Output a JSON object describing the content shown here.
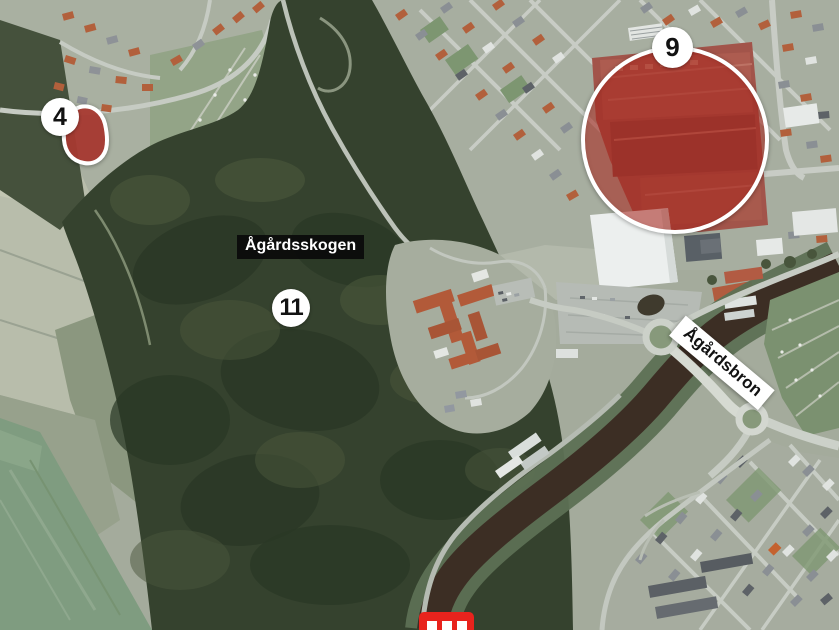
{
  "map": {
    "type": "annotated-aerial-map",
    "region_label": {
      "text": "Ågårdsskogen"
    },
    "bridge_label": {
      "text": "Ågårdsbron"
    },
    "markers": [
      {
        "number": "4",
        "highlight": "small-red-area"
      },
      {
        "number": "9",
        "highlight": "large-red-circle"
      },
      {
        "number": "11",
        "highlight": "none"
      }
    ],
    "logo": {
      "name": "publisher-logo-partial",
      "bars": 3
    },
    "colors": {
      "highlight_red": "#aa3a31",
      "circle_highlight_fill": "rgba(197,41,32,0.48)",
      "highlight_outline": "#ffffff",
      "marker_badge_bg": "#ffffff",
      "marker_badge_text": "#121212",
      "region_label_bg": "#0a0a0a",
      "region_label_text": "#ffffff",
      "bridge_label_bg": "#ffffff",
      "bridge_label_text": "#121212",
      "logo_red": "#e8231d",
      "forest_green": "#35422e",
      "river_brown": "#3c2e24"
    }
  }
}
